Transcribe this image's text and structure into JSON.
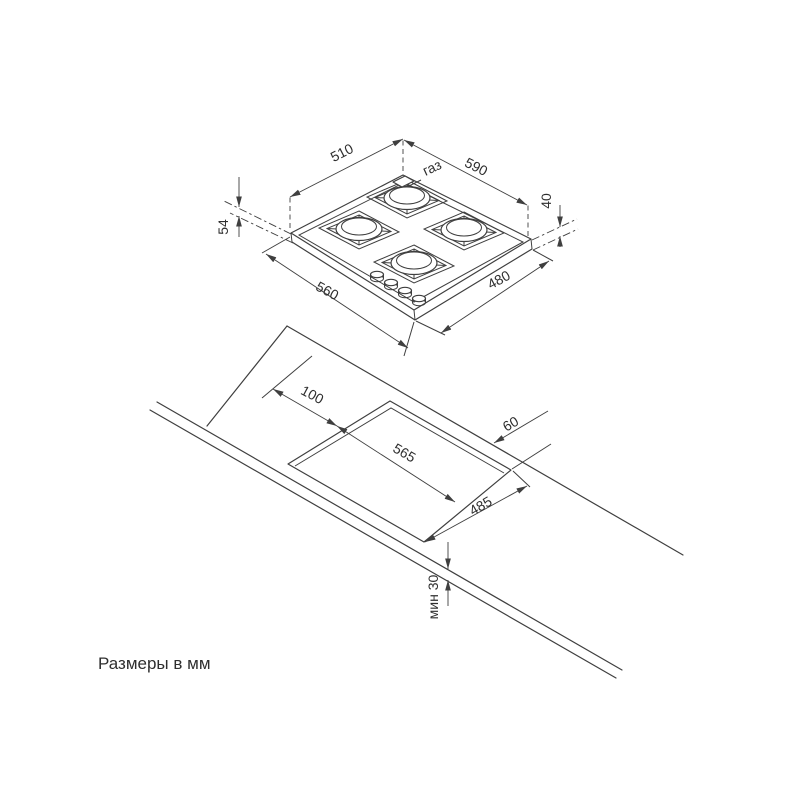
{
  "drawing": {
    "units_note": "Размеры в мм",
    "top_view": {
      "gas_label": "газ",
      "dim_glass_width_left": "510",
      "dim_overall_width_right": "590",
      "dim_height_left": "54",
      "dim_height_right": "40",
      "dim_front_width": "560",
      "dim_depth_right": "480"
    },
    "cutout_view": {
      "dim_offset_left": "100",
      "dim_cutout_width": "565",
      "dim_offset_back": "60",
      "dim_cutout_depth": "485",
      "dim_min_front": "мин 30"
    }
  }
}
